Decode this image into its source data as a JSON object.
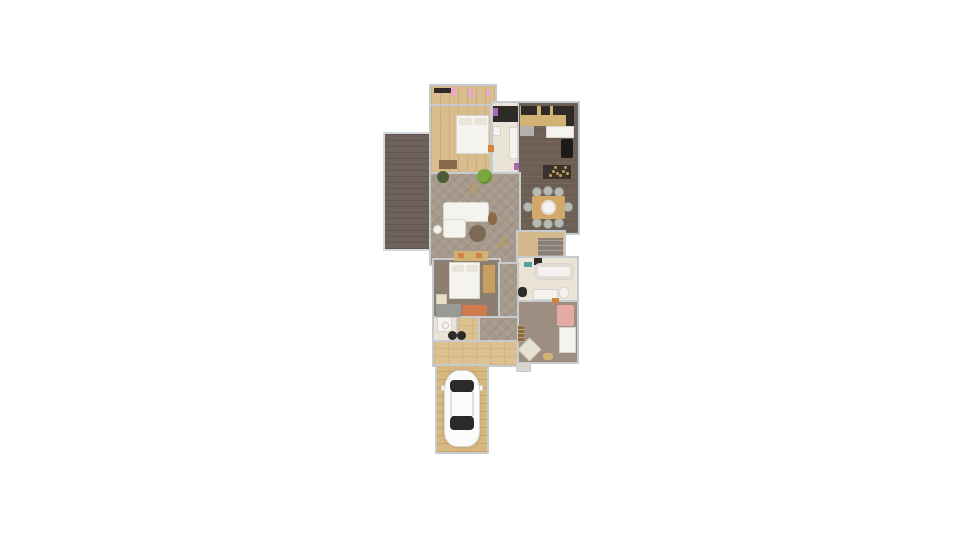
{
  "scene": {
    "type": "floor-plan",
    "description": "Top-down 2D rendered apartment floor plan on a white background: top bedroom with walk-in closet and small bathroom, kitchen with dining table for eight, large living room with L-shaped sofa, attached dark wood deck on the left, staircase, lower bathroom with tub, second bedroom, office/guest room with daybed, entry hallway and a driveway with a parked white car"
  },
  "palette": {
    "background": "#ffffff",
    "wall": "#c6cbd0",
    "wall_light": "#d4d8dc",
    "deck": "#6e615b",
    "wood_light": "#d9bd8f",
    "wood_hall": "#dcc291",
    "wood_drive": "#d8b87e",
    "floor_dark": "#6e5f55",
    "floor_living": "#a79a8c",
    "floor_taupe": "#8c7e71",
    "floor_mauve": "#9d8e81",
    "floor_cream": "#eae4d7",
    "stairs": "#8b8078",
    "landing": "#d3b98b",
    "counter_tan": "#d2b274",
    "appliance_dark": "#2e2a27",
    "island_dark": "#3a332d",
    "fridge_black": "#1d1b19",
    "white_furniture": "#f5f3ef",
    "gray_mat": "#b5b1aa",
    "table_tan": "#d2a96a",
    "chair_gray": "#b7bcb3",
    "rug_round": "#7d6a55",
    "plant_dark": "#4c5c38",
    "plant_green": "#7aa83e",
    "gold": "#c2a050",
    "bench_brown": "#8a6a48",
    "wardrobe_tan": "#c89f60",
    "rug_orange": "#cf7b4e",
    "desk_gray": "#979a95",
    "dresser_cream": "#e9dec9",
    "rug_pink": "#e5aaa2",
    "chair_cream": "#e7e3d3",
    "ladder_brown": "#8a6a3a",
    "pink_item": "#e8a8c8",
    "purple_item": "#a868b0",
    "teal_item": "#52a0a0",
    "orange_item": "#d08442",
    "step": "#d8d5ce",
    "car_body": "#fbfbfb",
    "car_glass": "#2a2a2a"
  }
}
